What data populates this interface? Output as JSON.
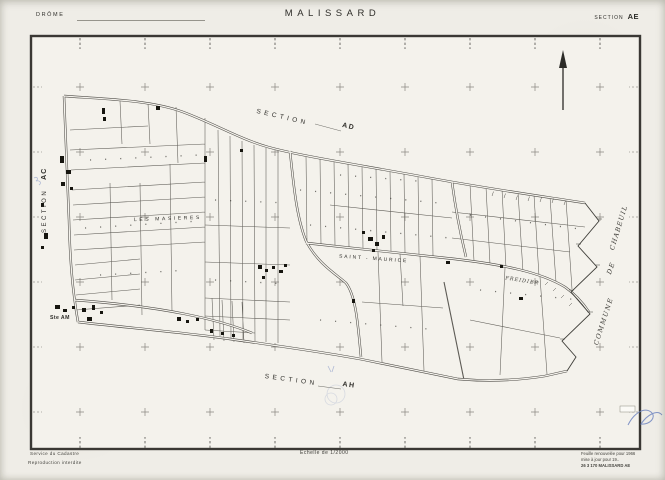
{
  "header": {
    "department": "DRÔME",
    "title": "MALISSARD",
    "section_word": "SECTION",
    "section_code": "AE"
  },
  "map_labels": {
    "section_left_word": "SECTION",
    "section_left_code": "AC",
    "section_top_word": "SECTION",
    "section_top_code": "AD",
    "section_bottom_word": "SECTION",
    "section_bottom_code": "AH",
    "commune_right": [
      "COMMUNE",
      "DE",
      "CHABEUIL"
    ],
    "lieu_les_masieres": "LES MASIERES",
    "lieu_saint_maurice": "SAINT - MAURICE",
    "lieu_freidier": "FREIDIER",
    "lieu_ste_am": "Ste AM"
  },
  "footer": {
    "credit_line1": "Service du Cadastre",
    "credit_line2": "Reproduction interdite",
    "scale": "Echelle de 1/2000",
    "note_line1": "Feuille renouvelée pour 1966",
    "note_line2": "mise à jour pour 19..",
    "note_line3": "26 3 170 MALISSARD AE"
  },
  "icons": {
    "north_arrow": "↑"
  },
  "colors": {
    "paper": "#f2f0ea",
    "ink": "#2f2e2a",
    "parcel_line": "#5d5b55",
    "blue_ink": "#6d84c0"
  }
}
